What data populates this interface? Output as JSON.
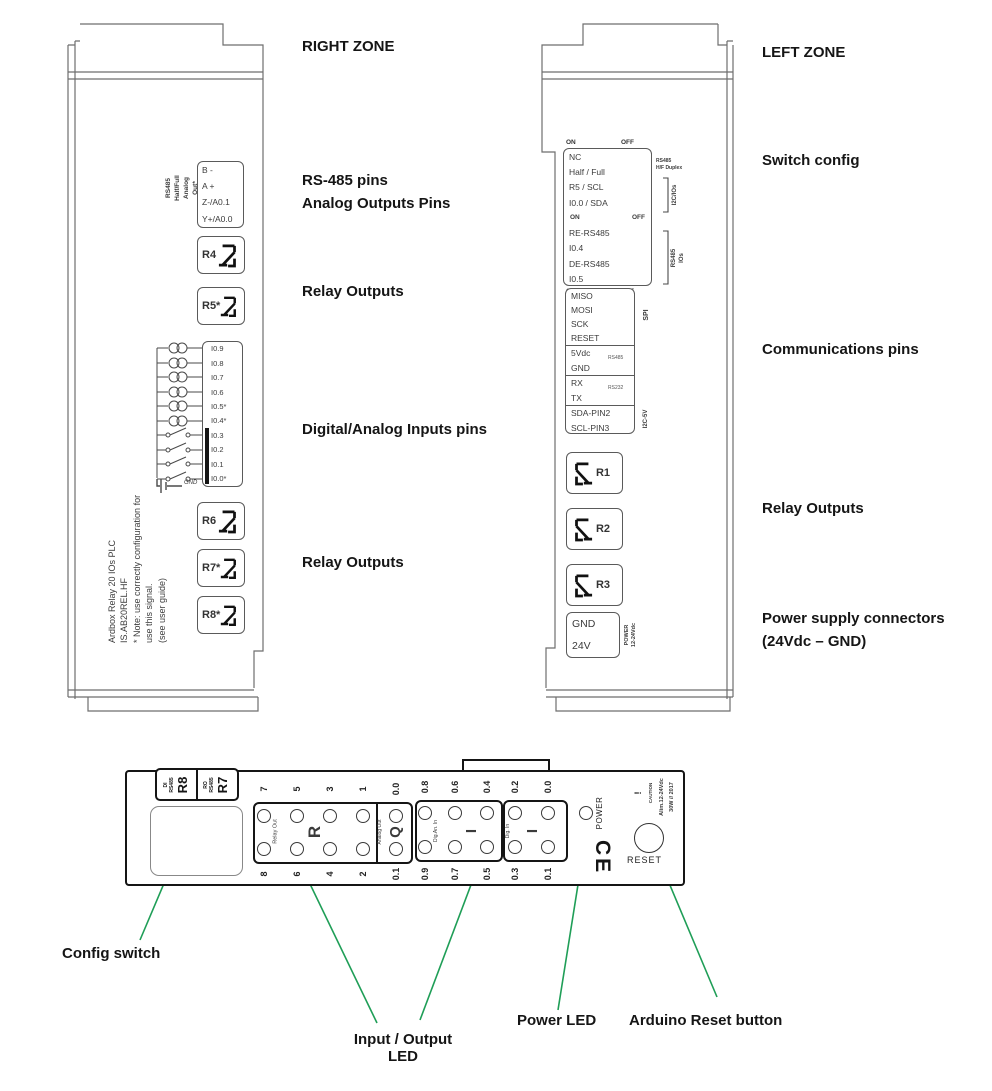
{
  "colors": {
    "callout_green": "#1f9e57",
    "line_gray": "#6e6e6e"
  },
  "right_zone": {
    "title": "RIGHT ZONE",
    "annotations": {
      "rs485_pins": "RS-485 pins",
      "analog_outputs": "Analog Outputs Pins",
      "relay_outputs_top": "Relay Outputs",
      "inputs": "Digital/Analog Inputs pins",
      "relay_outputs_bottom": "Relay Outputs"
    },
    "rs485_analog_label": [
      "RS485",
      "Half/Full",
      "Analog",
      "Out*"
    ],
    "rs485_terminal": [
      "B -",
      "A +",
      "Z-/A0.1",
      "Y+/A0.0"
    ],
    "relays_top": [
      "R4",
      "R5*"
    ],
    "input_terminal": [
      "I0.9",
      "I0.8",
      "I0.7",
      "I0.6",
      "I0.5*",
      "I0.4*",
      "I0.3",
      "I0.2",
      "I0.1",
      "I0.0*"
    ],
    "gnd": "GND",
    "relays_bottom": [
      "R6",
      "R7*",
      "R8*"
    ],
    "side_text": [
      "Ardbox Relay 20 IOs PLC",
      "IS.AB20REL.HF",
      "* Note: use correctly configuration for",
      "use this signal.",
      "(see user guide)"
    ]
  },
  "left_zone": {
    "title": "LEFT ZONE",
    "annotations": {
      "switch_config": "Switch config",
      "communications": "Communications pins",
      "relay_outputs": "Relay Outputs",
      "power_line1": "Power supply connectors",
      "power_line2": "(24Vdc – GND)"
    },
    "on": "ON",
    "off": "OFF",
    "switch_rows": [
      "NC",
      "Half / Full",
      "R5 / SCL",
      "I0.0 / SDA",
      "RE-RS485",
      "I0.4",
      "DE-RS485",
      "I0.5"
    ],
    "side_labels": {
      "duplex_line1": "RS485",
      "duplex_line2": "H/F Duplex",
      "i2c_ios": "I2C/IOs",
      "rs485_ios_line1": "RS485",
      "rs485_ios_line2": "IOs"
    },
    "comm": {
      "spi_rows": [
        "MISO",
        "MOSI",
        "SCK",
        "RESET"
      ],
      "spi": "SPI",
      "vdc_rows": [
        "5Vdc",
        "GND"
      ],
      "rs485": "RS485",
      "serial_rows": [
        "RX",
        "TX"
      ],
      "rs232": "RS232",
      "i2c_rows": [
        "SDA-PIN2",
        "SCL-PIN3"
      ],
      "i2c": "I2C-5V"
    },
    "relays": [
      "R1",
      "R2",
      "R3"
    ],
    "power_terminal": [
      "GND",
      "24V"
    ],
    "power_label": [
      "POWER",
      "12-24Vdc"
    ]
  },
  "bottom_view": {
    "di_cell": {
      "line1": "DI",
      "line2": "RS485",
      "big": "R8"
    },
    "ro_cell": {
      "line1": "RO",
      "line2": "RS485",
      "big": "R7"
    },
    "relay_leds": {
      "top": [
        "7",
        "5",
        "3",
        "1"
      ],
      "bottom": [
        "8",
        "6",
        "4",
        "2"
      ],
      "label": "Relay Out",
      "letter": "R"
    },
    "analog_leds": {
      "top": "0.0",
      "bottom": "0.1",
      "label": "Analog Out",
      "letter": "Q"
    },
    "digan_leds": {
      "top": [
        "0.8",
        "0.6",
        "0.4"
      ],
      "bottom": [
        "0.9",
        "0.7",
        "0.5"
      ],
      "label": "Dig.An. In",
      "letter": "I"
    },
    "dig_leds": {
      "top": [
        "0.2",
        "0.0"
      ],
      "bottom": [
        "0.3",
        "0.1"
      ],
      "label": "Dig. In",
      "letter": "I"
    },
    "power_led": "POWER",
    "ce": "CE",
    "caution": {
      "mark": "!",
      "title": "CAUTION",
      "line1": "Alim.12-24Vdc",
      "line2": "30W // 2017"
    },
    "reset": "RESET"
  },
  "callouts": {
    "config_switch": "Config switch",
    "io_led_line1": "Input / Output",
    "io_led_line2": "LED",
    "power_led": "Power LED",
    "reset_button": "Arduino Reset button"
  }
}
